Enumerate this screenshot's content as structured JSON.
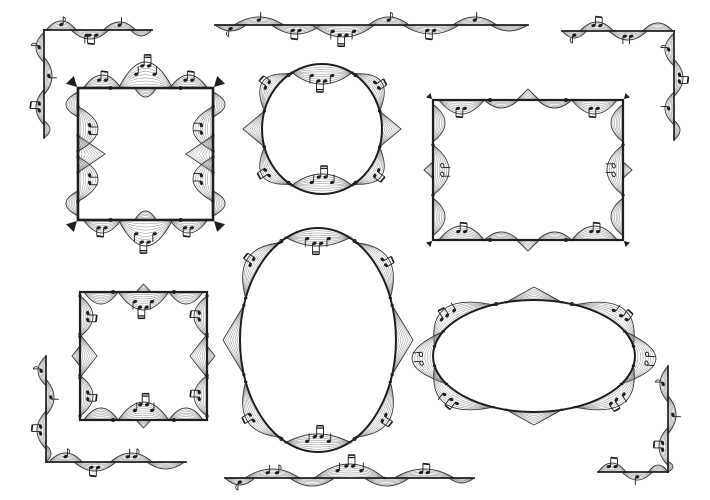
{
  "canvas": {
    "width": 710,
    "height": 500,
    "background": "#ffffff"
  },
  "palette": {
    "ink": "#1f1f1f",
    "staff": "#8f8f8f",
    "staff_dark": "#3a3a3a",
    "background": "#ffffff"
  },
  "graphics": {
    "items": [
      {
        "id": "square-frame-music-outward",
        "type": "rect",
        "x": 78,
        "y": 88,
        "w": 135,
        "h": 132,
        "sw": 2.6,
        "wedge": 12,
        "edges": {
          "top": [
            [
              0.04,
              0.32,
              13,
              "e2"
            ],
            [
              0.3,
              0.7,
              26,
              "q,be,q"
            ],
            [
              0.68,
              0.96,
              13,
              "e2"
            ],
            [
              0.42,
              0.58,
              -9
            ]
          ],
          "right": [
            [
              0.03,
              0.22,
              12
            ],
            [
              0.14,
              0.48,
              -20,
              "q,q"
            ],
            [
              0.36,
              0.64,
              -27,
              "",
              1
            ],
            [
              0.52,
              0.86,
              -20,
              "q,q"
            ],
            [
              0.78,
              0.97,
              12
            ]
          ],
          "bottom": [
            [
              0.04,
              0.32,
              13,
              "e2"
            ],
            [
              0.3,
              0.7,
              26,
              "q,be,q"
            ],
            [
              0.68,
              0.96,
              13,
              "e2"
            ],
            [
              0.42,
              0.58,
              -9
            ]
          ],
          "left": [
            [
              0.03,
              0.22,
              12
            ],
            [
              0.14,
              0.48,
              -20,
              "q,q"
            ],
            [
              0.36,
              0.64,
              -27,
              "",
              1
            ],
            [
              0.52,
              0.86,
              -20,
              "q,q"
            ],
            [
              0.78,
              0.97,
              12
            ]
          ]
        },
        "marks": {
          "top": [
            [
              0.24,
              "o"
            ],
            [
              0.3,
              "ticks"
            ],
            [
              0.7,
              "ticks"
            ],
            [
              0.76,
              "o"
            ]
          ],
          "bottom": [
            [
              0.24,
              "o"
            ],
            [
              0.3,
              "ticks"
            ],
            [
              0.7,
              "ticks"
            ],
            [
              0.76,
              "o"
            ]
          ]
        }
      },
      {
        "id": "circle-frame-music",
        "type": "ellipse",
        "cx": 322,
        "cy": 129,
        "rx": 60,
        "ry": 65,
        "sw": 2,
        "lobes": [
          [
            240,
            300,
            -20,
            "q,be,q"
          ],
          [
            60,
            120,
            -20,
            "q,be,q"
          ],
          [
            302,
            344,
            14,
            "e2"
          ],
          [
            196,
            238,
            14,
            "e2"
          ],
          [
            16,
            58,
            14,
            "e2"
          ],
          [
            122,
            164,
            14,
            "e2"
          ],
          [
            344,
            376,
            19,
            "",
            1
          ],
          [
            164,
            196,
            19,
            "",
            1
          ]
        ],
        "marks": [
          [
            236,
            "o"
          ],
          [
            304,
            "o"
          ],
          [
            56,
            "o"
          ],
          [
            124,
            "o"
          ]
        ]
      },
      {
        "id": "rectangle-frame-music",
        "type": "rect",
        "x": 433,
        "y": 100,
        "w": 190,
        "h": 140,
        "sw": 2.2,
        "wedge": 7,
        "edges": {
          "top": [
            [
              0.03,
              0.27,
              -14,
              "e2"
            ],
            [
              0.27,
              0.45,
              -8
            ],
            [
              0.44,
              0.56,
              11,
              "",
              1
            ],
            [
              0.55,
              0.73,
              -8
            ],
            [
              0.73,
              0.97,
              -14,
              "e2"
            ]
          ],
          "right": [
            [
              0.03,
              0.3,
              -12
            ],
            [
              0.32,
              0.68,
              -16,
              "h,h"
            ],
            [
              0.44,
              0.56,
              9,
              "",
              1
            ],
            [
              0.7,
              0.97,
              -12
            ]
          ],
          "bottom": [
            [
              0.03,
              0.27,
              -14,
              "e2"
            ],
            [
              0.27,
              0.45,
              -8
            ],
            [
              0.44,
              0.56,
              11,
              "",
              1
            ],
            [
              0.55,
              0.73,
              -8
            ],
            [
              0.73,
              0.97,
              -14,
              "e2"
            ]
          ],
          "left": [
            [
              0.03,
              0.3,
              -12
            ],
            [
              0.32,
              0.68,
              -16,
              "h,h"
            ],
            [
              0.44,
              0.56,
              9,
              "",
              1
            ],
            [
              0.7,
              0.97,
              -12
            ]
          ]
        },
        "marks": {
          "top": [
            [
              0.3,
              "o"
            ],
            [
              0.7,
              "o"
            ]
          ],
          "bottom": [
            [
              0.3,
              "o"
            ],
            [
              0.7,
              "o"
            ]
          ]
        }
      },
      {
        "id": "square-frame-music-inward",
        "type": "rect",
        "x": 80,
        "y": 292,
        "w": 127,
        "h": 128,
        "sw": 2.2,
        "edges": {
          "top": [
            [
              0.03,
              0.3,
              -12
            ],
            [
              0.3,
              0.7,
              -18,
              "q,be,q"
            ],
            [
              0.7,
              0.97,
              -12
            ],
            [
              0.44,
              0.56,
              8,
              "",
              1
            ]
          ],
          "right": [
            [
              0.03,
              0.35,
              -13,
              "e2"
            ],
            [
              0.33,
              0.67,
              -17,
              "",
              1
            ],
            [
              0.65,
              0.97,
              -13,
              "e2"
            ],
            [
              0.42,
              0.58,
              8,
              "",
              1
            ]
          ],
          "bottom": [
            [
              0.03,
              0.3,
              -12
            ],
            [
              0.3,
              0.7,
              -18,
              "q,be,q"
            ],
            [
              0.7,
              0.97,
              -12
            ],
            [
              0.44,
              0.56,
              8,
              "",
              1
            ]
          ],
          "left": [
            [
              0.03,
              0.35,
              -13,
              "e2"
            ],
            [
              0.33,
              0.67,
              -17,
              "",
              1
            ],
            [
              0.65,
              0.97,
              -13,
              "e2"
            ],
            [
              0.42,
              0.58,
              8,
              "",
              1
            ]
          ]
        },
        "marks": {
          "top": [
            [
              0.18,
              "ticks"
            ],
            [
              0.26,
              "o"
            ],
            [
              0.74,
              "o"
            ],
            [
              0.82,
              "ticks"
            ]
          ],
          "bottom": [
            [
              0.18,
              "ticks"
            ],
            [
              0.26,
              "o"
            ],
            [
              0.74,
              "o"
            ],
            [
              0.82,
              "ticks"
            ]
          ]
        }
      },
      {
        "id": "oval-frame-music-vertical",
        "type": "ellipse",
        "cx": 318,
        "cy": 340,
        "rx": 78,
        "ry": 112,
        "sw": 2,
        "lobes": [
          [
            246,
            294,
            -18,
            "q,be,q"
          ],
          [
            66,
            114,
            -18,
            "q,be,q"
          ],
          [
            300,
            338,
            14,
            "e2"
          ],
          [
            202,
            240,
            14,
            "e2"
          ],
          [
            22,
            60,
            14,
            "e2"
          ],
          [
            120,
            158,
            14,
            "e2"
          ],
          [
            342,
            378,
            17,
            "",
            1
          ],
          [
            162,
            198,
            17,
            "",
            1
          ]
        ],
        "marks": [
          [
            242,
            "o"
          ],
          [
            298,
            "o"
          ],
          [
            62,
            "o"
          ],
          [
            118,
            "o"
          ]
        ]
      },
      {
        "id": "ellipse-frame-music-horizontal",
        "type": "ellipse",
        "cx": 534,
        "cy": 356,
        "rx": 101,
        "ry": 56,
        "sw": 2,
        "lobes": [
          [
            254,
            286,
            13,
            "",
            1
          ],
          [
            190,
            246,
            16,
            "e2,q"
          ],
          [
            294,
            350,
            16,
            "q,e2"
          ],
          [
            150,
            206,
            21,
            "h,h"
          ],
          [
            -26,
            30,
            21,
            "h,h"
          ],
          [
            74,
            106,
            13,
            "",
            1
          ],
          [
            114,
            170,
            16,
            "e2,q"
          ],
          [
            10,
            66,
            16,
            "q,e2"
          ]
        ],
        "marks": [
          [
            248,
            "o"
          ],
          [
            292,
            "o"
          ]
        ]
      },
      {
        "id": "corner-ornament-top-left",
        "type": "lines",
        "sw": 1.7,
        "segments": [
          {
            "a": [
              44,
              30
            ],
            "b": [
              152,
              30
            ],
            "lobes": [
              [
                0.02,
                0.3,
                9,
                "e"
              ],
              [
                0.25,
                0.6,
                -9,
                "q,e2"
              ],
              [
                0.55,
                0.85,
                8,
                "q"
              ],
              [
                0.8,
                1.0,
                -6
              ]
            ]
          },
          {
            "a": [
              44,
              30
            ],
            "b": [
              44,
              138
            ],
            "lobes": [
              [
                0.02,
                0.3,
                -8,
                "e"
              ],
              [
                0.25,
                0.6,
                8,
                "q"
              ],
              [
                0.55,
                0.88,
                -8,
                "e2"
              ],
              [
                0.84,
                1.0,
                6
              ]
            ]
          }
        ]
      },
      {
        "id": "divider-ornament-top",
        "type": "lines",
        "sw": 1.8,
        "segments": [
          {
            "a": [
              215,
              25
            ],
            "b": [
              528,
              25
            ],
            "lobes": [
              [
                0.0,
                0.1,
                -6,
                "e"
              ],
              [
                0.06,
                0.22,
                8,
                "q"
              ],
              [
                0.18,
                0.34,
                -9,
                "e2"
              ],
              [
                0.31,
                0.51,
                -12,
                "q,be,q"
              ],
              [
                0.49,
                0.62,
                8,
                "e"
              ],
              [
                0.6,
                0.78,
                -9,
                "e2"
              ],
              [
                0.76,
                0.9,
                8,
                "q"
              ],
              [
                0.88,
                1.0,
                -6
              ]
            ]
          }
        ]
      },
      {
        "id": "corner-ornament-top-right",
        "type": "lines",
        "sw": 1.7,
        "segments": [
          {
            "a": [
              562,
              31
            ],
            "b": [
              674,
              31
            ],
            "lobes": [
              [
                0.0,
                0.22,
                -7,
                "e"
              ],
              [
                0.16,
                0.46,
                9,
                "e2"
              ],
              [
                0.42,
                0.76,
                -9,
                "q,q"
              ],
              [
                0.72,
                0.99,
                8
              ]
            ]
          },
          {
            "a": [
              674,
              31
            ],
            "b": [
              674,
              140
            ],
            "lobes": [
              [
                0.02,
                0.32,
                -9,
                "e"
              ],
              [
                0.26,
                0.6,
                9,
                "e2"
              ],
              [
                0.56,
                0.86,
                -9,
                "q"
              ],
              [
                0.82,
                1.0,
                6
              ]
            ]
          }
        ]
      },
      {
        "id": "corner-ornament-bottom-left",
        "type": "lines",
        "sw": 1.7,
        "segments": [
          {
            "a": [
              46,
              356
            ],
            "b": [
              46,
              462
            ],
            "lobes": [
              [
                0.0,
                0.28,
                -8,
                "e"
              ],
              [
                0.22,
                0.56,
                8,
                "q"
              ],
              [
                0.52,
                0.88,
                -9,
                "e2"
              ],
              [
                0.84,
                1.0,
                5
              ]
            ]
          },
          {
            "a": [
              46,
              462
            ],
            "b": [
              186,
              462
            ],
            "lobes": [
              [
                0.02,
                0.26,
                9,
                "e"
              ],
              [
                0.2,
                0.5,
                -9,
                "e2"
              ],
              [
                0.46,
                0.76,
                9,
                "q,e"
              ],
              [
                0.72,
                0.99,
                -7
              ]
            ]
          }
        ]
      },
      {
        "id": "divider-ornament-bottom",
        "type": "lines",
        "sw": 1.8,
        "segments": [
          {
            "a": [
              225,
              478
            ],
            "b": [
              474,
              478
            ],
            "lobes": [
              [
                0.0,
                0.12,
                -7,
                "e"
              ],
              [
                0.08,
                0.3,
                9,
                "q,e"
              ],
              [
                0.26,
                0.44,
                -8
              ],
              [
                0.36,
                0.64,
                14,
                "q,be,q"
              ],
              [
                0.56,
                0.74,
                -8
              ],
              [
                0.68,
                0.92,
                9,
                "e2"
              ],
              [
                0.9,
                1.0,
                -5
              ]
            ]
          }
        ]
      },
      {
        "id": "corner-ornament-bottom-right",
        "type": "lines",
        "sw": 1.7,
        "segments": [
          {
            "a": [
              668,
              366
            ],
            "b": [
              668,
              472
            ],
            "lobes": [
              [
                0.0,
                0.34,
                -8,
                "e"
              ],
              [
                0.28,
                0.64,
                8,
                "q"
              ],
              [
                0.58,
                0.94,
                -9,
                "e2"
              ],
              [
                0.9,
                1.0,
                5
              ]
            ]
          },
          {
            "a": [
              598,
              472
            ],
            "b": [
              668,
              472
            ],
            "lobes": [
              [
                0.0,
                0.4,
                9,
                "e2"
              ],
              [
                0.34,
                0.78,
                -8,
                "q"
              ],
              [
                0.72,
                1.0,
                7
              ]
            ]
          }
        ]
      }
    ]
  }
}
